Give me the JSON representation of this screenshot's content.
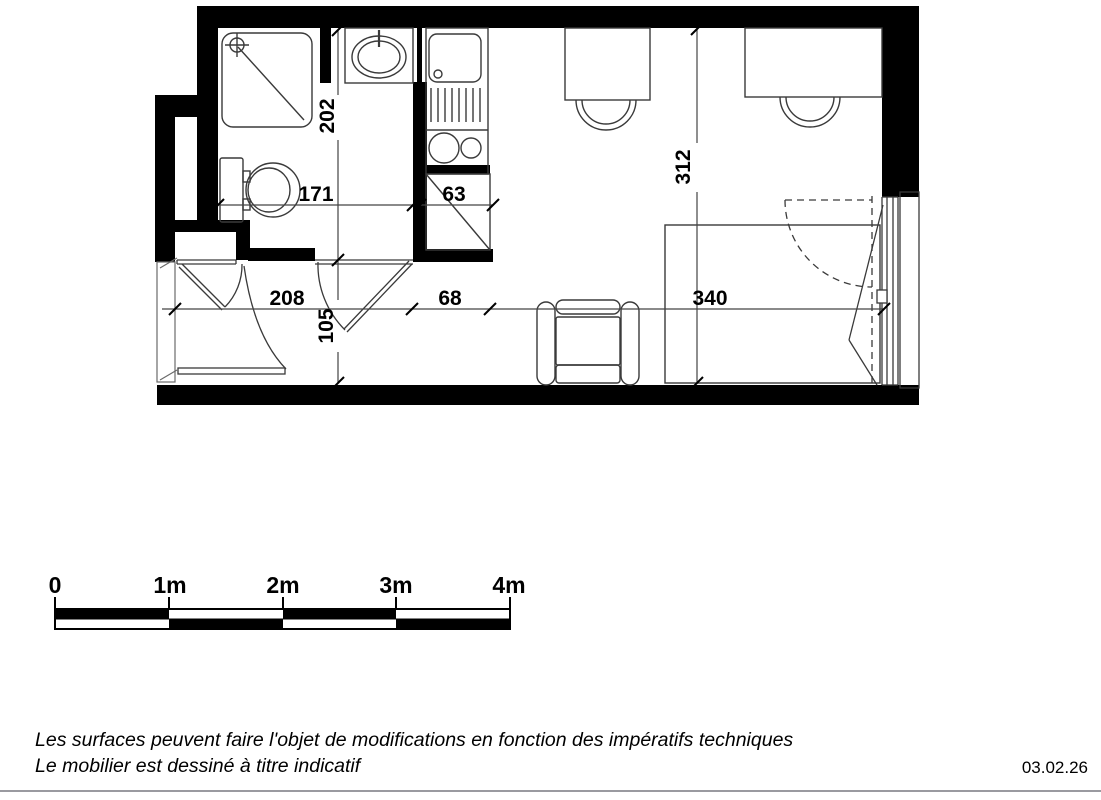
{
  "floorplan": {
    "dims": {
      "bathroom_depth": "202",
      "bathroom_width": "171",
      "closet_width": "63",
      "room_depth": "312",
      "entry_width": "208",
      "entry_depth": "105",
      "closet_bay_width": "68",
      "room_width": "340"
    },
    "fixtures": [
      "shower",
      "washbasin",
      "toilet",
      "kitchen-unit",
      "closet",
      "desk",
      "chair",
      "bed",
      "armchair",
      "entrance-door",
      "bathroom-door",
      "window"
    ],
    "wall_color": "#000000",
    "line_color": "#3a3a3a"
  },
  "scalebar": {
    "labels": [
      "0",
      "1m",
      "2m",
      "3m",
      "4m"
    ]
  },
  "footer": {
    "line1": "Les surfaces peuvent faire l'objet de modifications en fonction des impératifs techniques",
    "line2": "Le mobilier est dessiné à titre indicatif",
    "date": "03.02.26"
  }
}
